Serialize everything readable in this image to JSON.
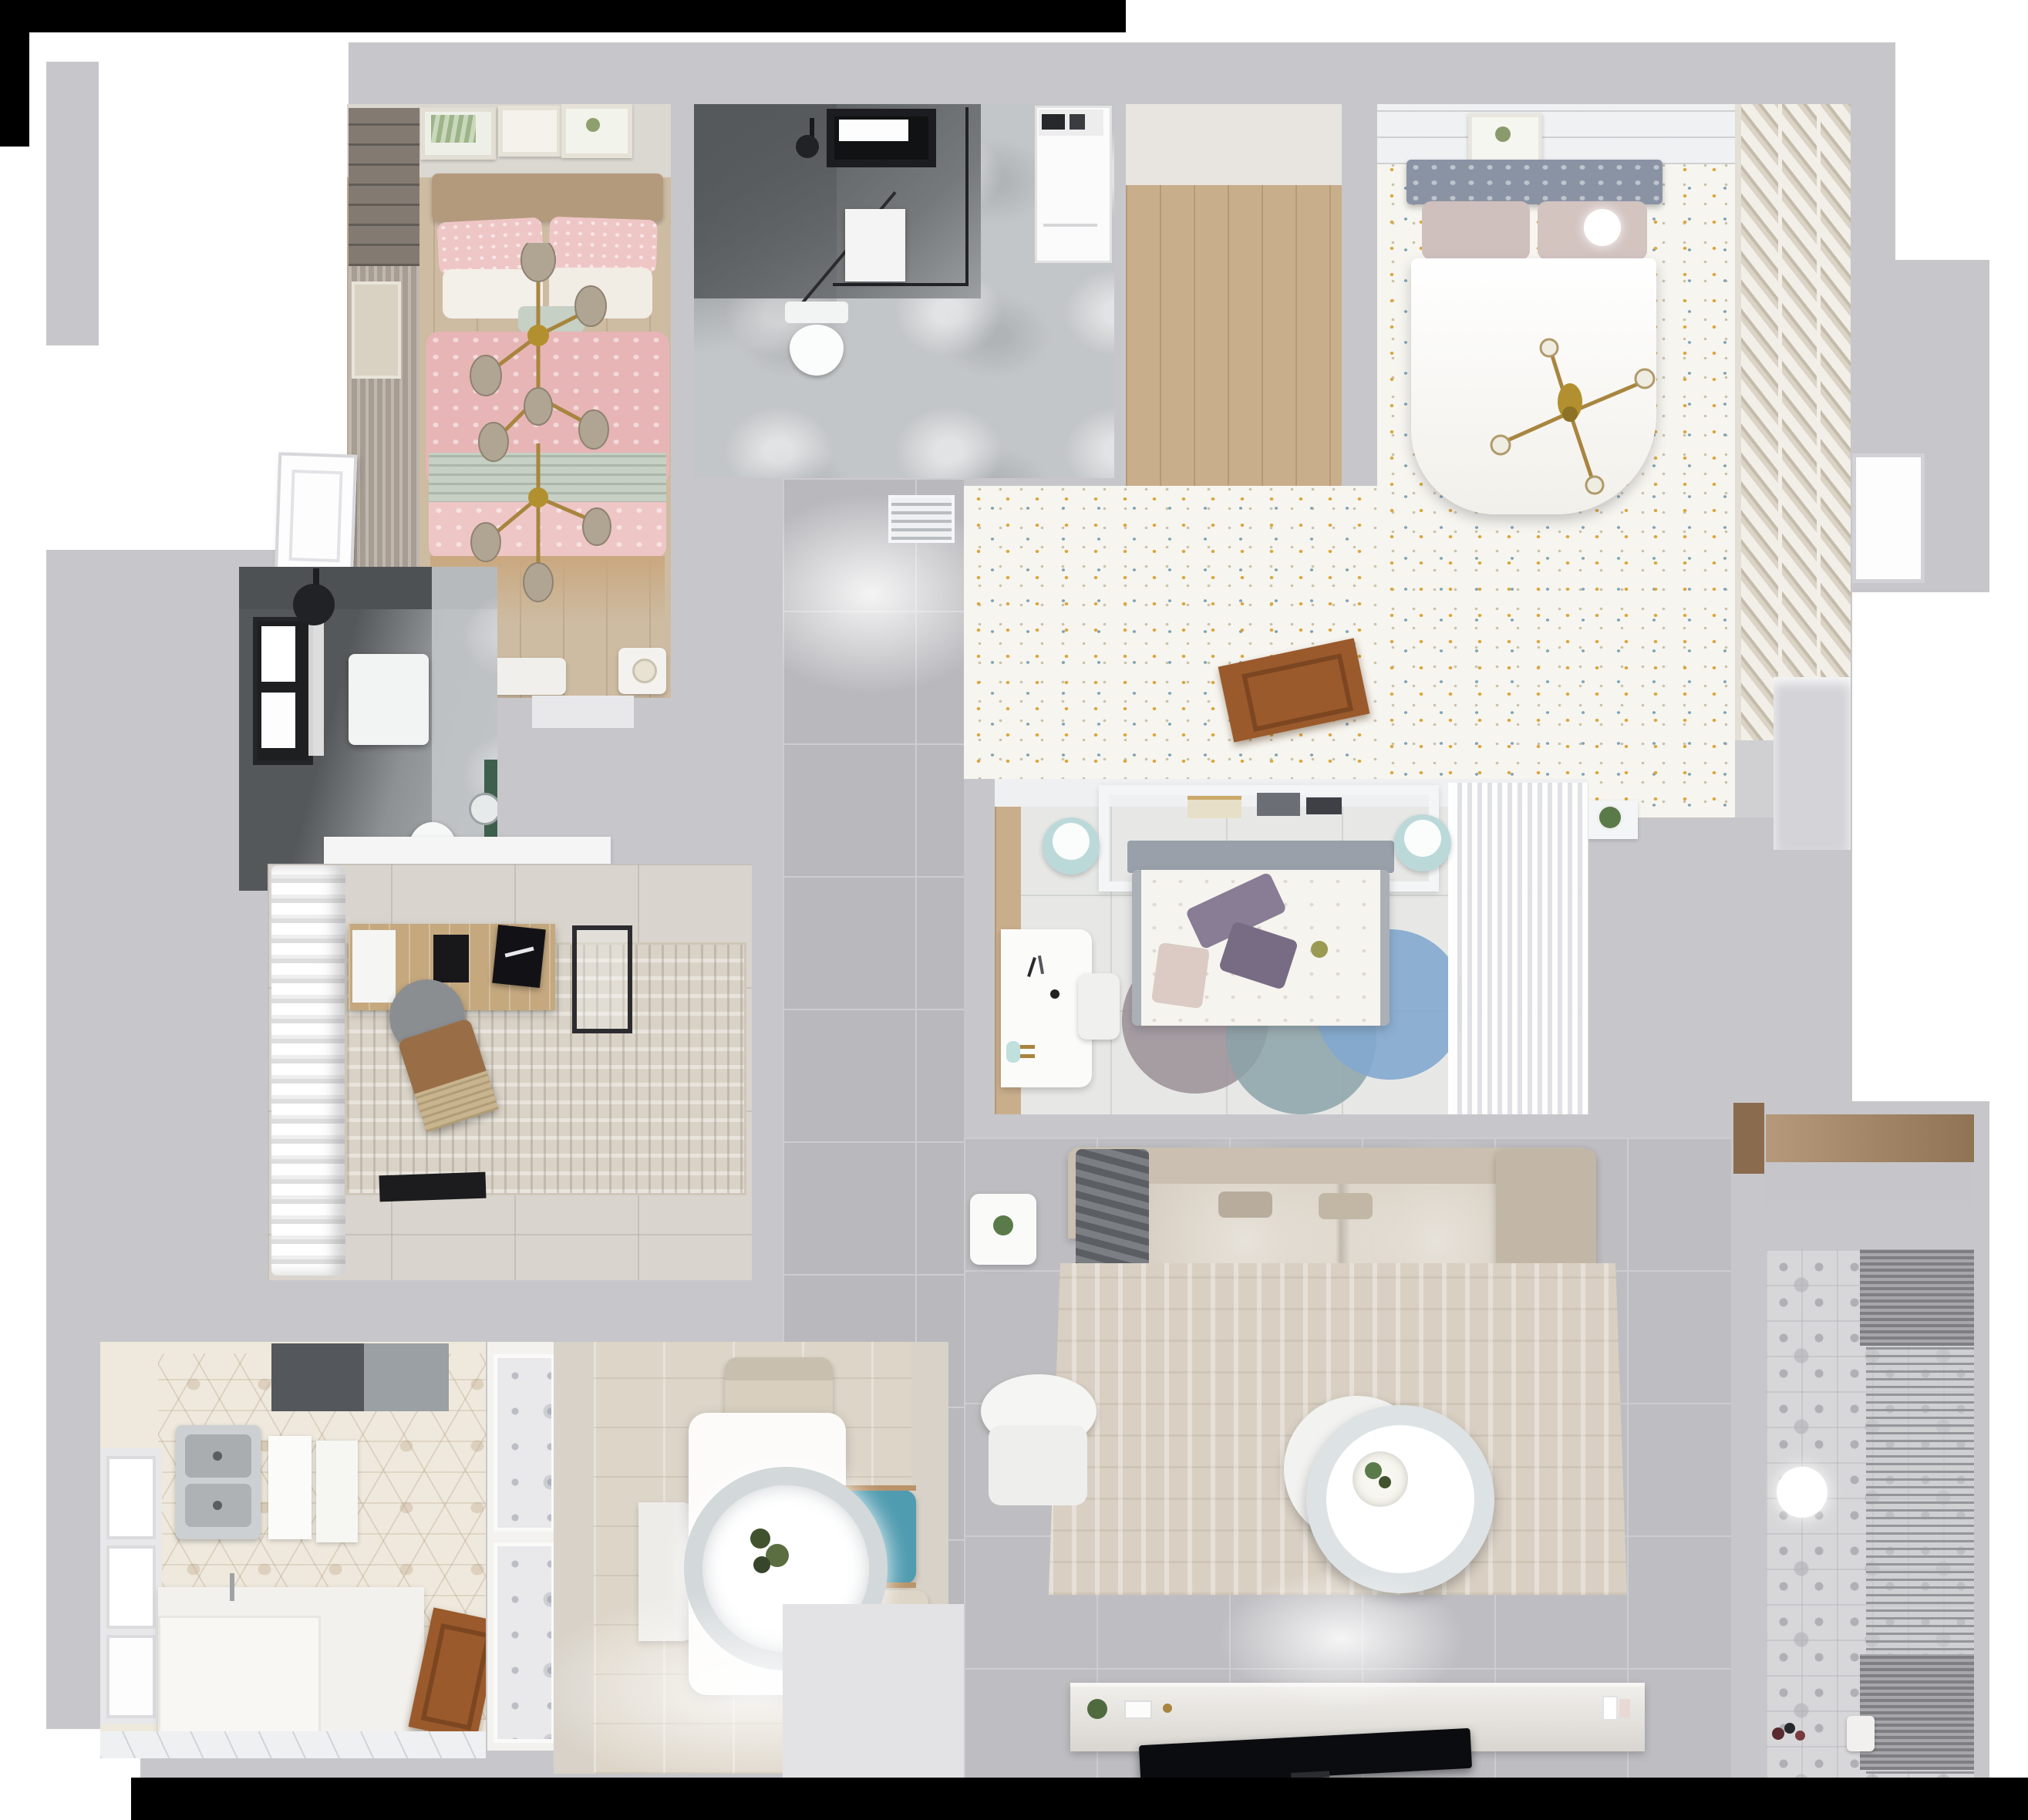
{
  "scene": {
    "kind": "3d-floorplan-top-down-render",
    "description": "Top-down 3D render of a furnished apartment floor plan",
    "visible_text": "none"
  },
  "palette": {
    "exterior": "#ffffff",
    "black_band": "#000000",
    "wall": "#c7c7cb",
    "wall_light": "#dadade",
    "hall_tile": "#b9b9bd",
    "tile_line": "#cdcdd1",
    "living_tile": "#bebec2",
    "wood_floor": "#cdbba2",
    "wood_mid": "#c9ae8c",
    "wood_door": "#9a5a2c",
    "wood_balcony": "#b5997a",
    "fridge_dark": "#54585c",
    "appliance_gray": "#9ba0a4",
    "shower_dark": "#5f6366",
    "bath_dark": "#55585b",
    "marble": "#c3c6c8",
    "pink": "#efc6c6",
    "pink_deep": "#e7b5b5",
    "sage": "#c6d0c4",
    "cream": "#e9e5dd",
    "floral_base": "#f7f5ef",
    "speck_gold": "#d9a73e",
    "speck_blue": "#7da3b5",
    "headboard_gray": "#8a93a4",
    "b2_floor": "#e7e8e6",
    "teal_stool": "#bcd9da",
    "purple": "#897d95",
    "rug_mauve": "#9a8f96",
    "rug_teal": "#8ba3a8",
    "rug_blue": "#82a9cf",
    "study_floor": "#d9d4cd",
    "rug_beige": "#d9d2c6",
    "chair_gray": "#8b8e91",
    "chair_brown": "#996e46",
    "kitchen_base": "#efe9dd",
    "hex_line": "#b9a88e",
    "dining_floor": "#d8d2c8",
    "table_white": "#fcfbf9",
    "chair_beige": "#d8cfbf",
    "teal_chair": "#4f9bb0",
    "sofa": "#cabfb0",
    "sofa_seat": "#cfc5b5",
    "living_rug": "#d9d0c3",
    "console": "#e5e2dd",
    "tv_black": "#0b0c0f",
    "balcony_tile": "#d7d7d9",
    "blind": "#95959a",
    "gold": "#a8853f",
    "green": "#4a5e3a",
    "white": "#ffffff",
    "off_white": "#f4f4f6",
    "door_white": "#fdfdfe"
  },
  "rooms": [
    {
      "id": "bedroom-pink",
      "furniture": [
        "double-bed-pink",
        "gold-branch-chandelier",
        "wall-art-frames",
        "roman-curtain",
        "nightstand",
        "dresser",
        "door-opening"
      ]
    },
    {
      "id": "bathroom-shower",
      "furniture": [
        "skylight-window",
        "glass-shower",
        "shower-head",
        "washing-machine",
        "toilet",
        "wall-panel"
      ]
    },
    {
      "id": "walk-in-closet",
      "furniture": [
        "wood-floor"
      ]
    },
    {
      "id": "master-bedroom",
      "furniture": [
        "double-bed-white",
        "tufted-headboard",
        "gold-cross-chandelier",
        "ball-lamp",
        "wall-art",
        "louvered-wardrobe",
        "floral-carpet",
        "plant-ledge",
        "white-door"
      ]
    },
    {
      "id": "upper-hallway",
      "furniture": [
        "air-vent-grille",
        "wood-door-panel",
        "speckled-carpet"
      ]
    },
    {
      "id": "corridor",
      "furniture": [
        "gray-floor-tiles"
      ]
    },
    {
      "id": "kids-bedroom",
      "furniture": [
        "bed-floral-duvet",
        "overbed-shelf-frame",
        "books",
        "teal-stools",
        "study-desk",
        "desk-chair",
        "round-rugs",
        "sheer-wardrobe"
      ]
    },
    {
      "id": "dark-bathroom",
      "furniture": [
        "window",
        "ceiling-shower",
        "wall-cabinet",
        "toilet",
        "round-mirror",
        "green-accent"
      ]
    },
    {
      "id": "study",
      "furniture": [
        "billowy-curtains",
        "writing-desk",
        "laptop",
        "monitor-art",
        "office-chair",
        "lounge-chair",
        "distressed-rug",
        "floor-mat",
        "wall-shelf"
      ]
    },
    {
      "id": "kitchen",
      "furniture": [
        "hex-tile-floor",
        "fridge",
        "double-sink",
        "cutting-boards",
        "window",
        "l-counter",
        "wood-door"
      ]
    },
    {
      "id": "dining",
      "furniture": [
        "dining-table",
        "ring-pendant-lamp",
        "plant-centerpiece",
        "beige-chairs",
        "teal-chair",
        "entry-doormat",
        "gold-handles"
      ]
    },
    {
      "id": "living-room",
      "furniture": [
        "l-shaped-sofa",
        "throw-blanket",
        "area-rug",
        "round-coffee-table",
        "armchair",
        "side-table",
        "tv-console",
        "flat-tv",
        "decor-plants"
      ]
    },
    {
      "id": "balcony-laundry",
      "furniture": [
        "patterned-tile-floor",
        "venetian-blinds",
        "sphere-lamp",
        "storage-niche-wood",
        "toys",
        "watering-can"
      ]
    }
  ]
}
